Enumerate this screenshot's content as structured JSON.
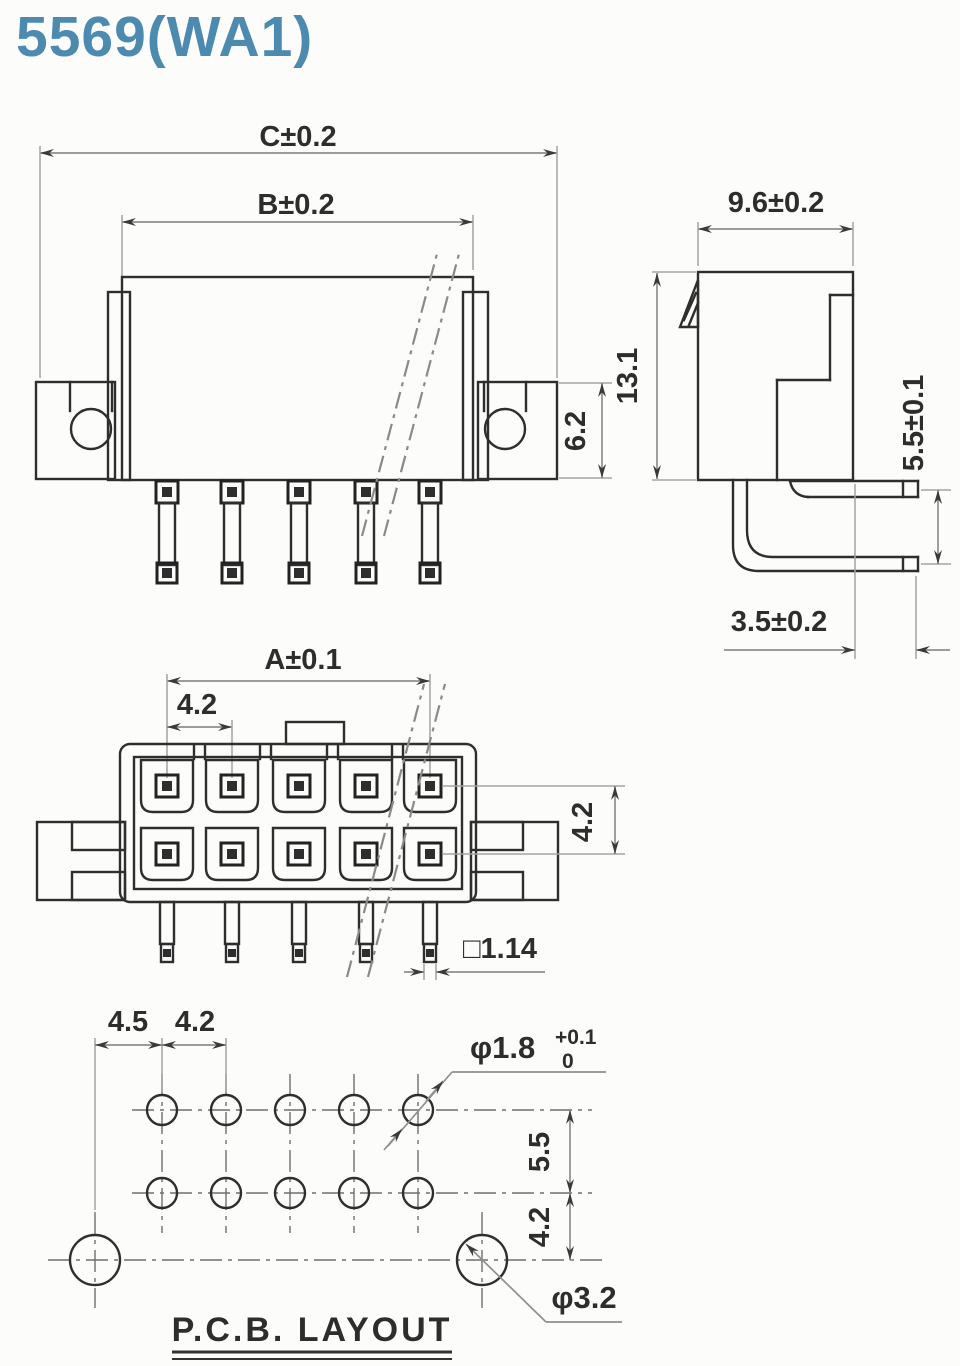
{
  "title": "5569(WA1)",
  "colors": {
    "title": "#4d8ab0",
    "line": "#2e2e2e",
    "dimension": "#8f8f8f",
    "background": "#fbfbf9"
  },
  "front_view": {
    "dim_overall_width": "C±0.2",
    "dim_body_width": "B±0.2",
    "dim_bracket_height": "6.2"
  },
  "side_view": {
    "dim_depth": "9.6±0.2",
    "dim_height": "13.1",
    "dim_pin_row_offset": "5.5±0.1",
    "dim_pin_tail": "3.5±0.2"
  },
  "face_view": {
    "dim_pin_span": "A±0.1",
    "dim_pin_pitch": "4.2",
    "dim_row_pitch": "4.2",
    "dim_pin_square": "□1.14"
  },
  "pcb_layout": {
    "caption": "P.C.B. LAYOUT",
    "dim_mount_to_pin": "4.5",
    "dim_hole_pitch": "4.2",
    "dim_row_gap": "5.5",
    "dim_mount_row_gap": "4.2",
    "pin_hole_diameter": "φ1.8",
    "pin_hole_tol_upper": "+0.1",
    "pin_hole_tol_lower": "0",
    "mount_hole_diameter": "φ3.2"
  }
}
